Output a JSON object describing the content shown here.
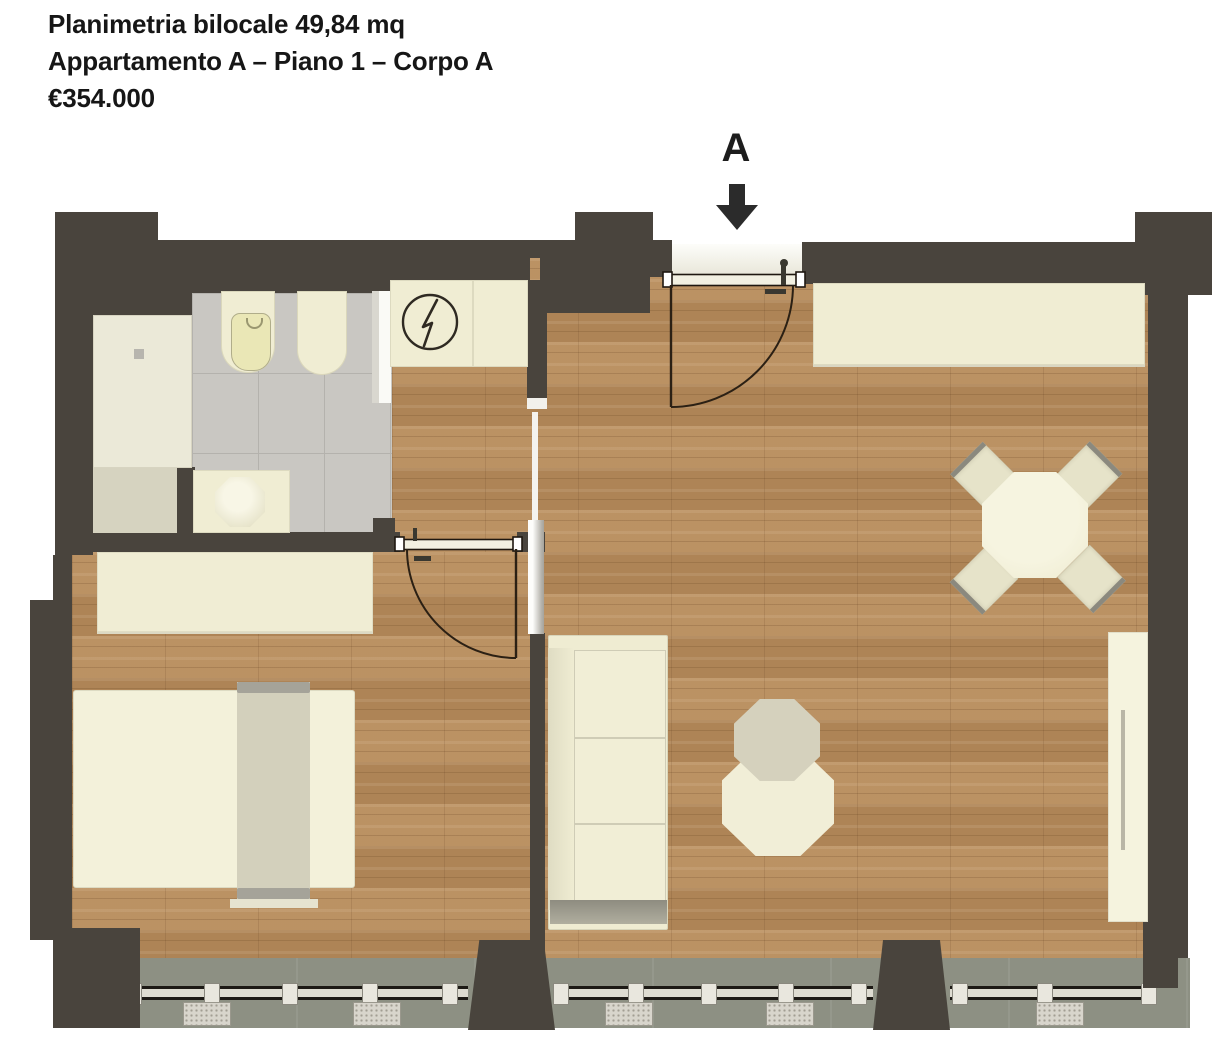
{
  "header": {
    "line1": "Planimetria bilocale 49,84 mq",
    "line2": "Appartamento A – Piano 1 – Corpo A",
    "line3": "€354.000"
  },
  "entrance": {
    "label": "A",
    "direction_icon": "down-arrow-icon"
  },
  "symbols": {
    "electrical_panel": "lightning-in-circle"
  },
  "colors": {
    "wall": "#49443d",
    "wood": "#b78c5d",
    "tile": "#c9c7c2",
    "cream": "#f0edd3",
    "beige": "#d3d0bc",
    "balcony": "#8d9083",
    "line": "#2b2014",
    "text": "#161616"
  }
}
